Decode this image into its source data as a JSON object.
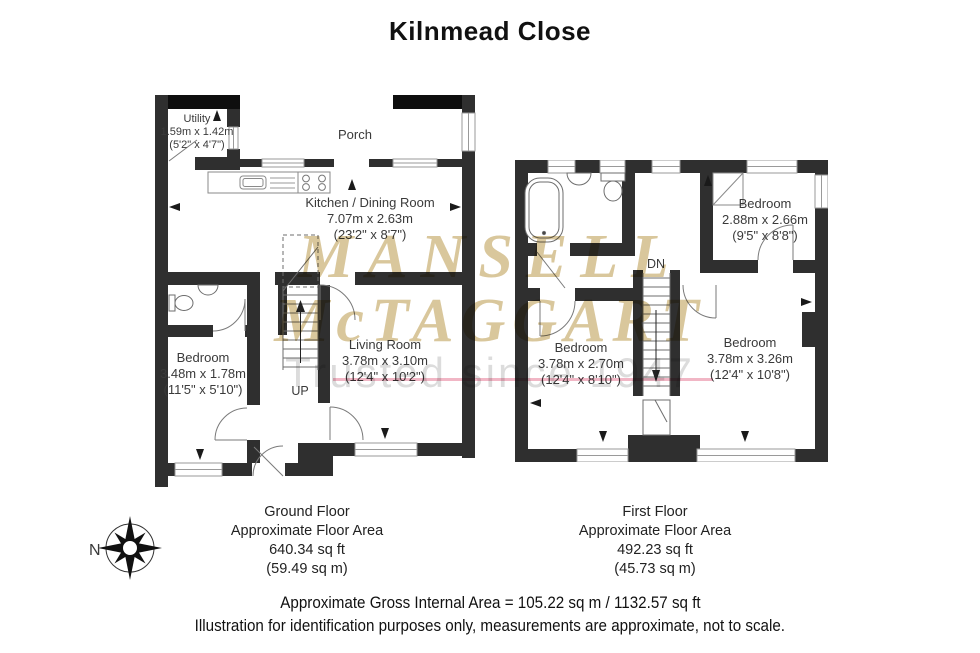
{
  "title": "Kilnmead Close",
  "watermark": {
    "line1": "MANSELL",
    "line2": "McTAGGART",
    "tagline": "Trusted since 1947"
  },
  "compass": {
    "north_label": "N"
  },
  "ground_floor": {
    "stairs_label": "UP",
    "rooms": {
      "utility": {
        "name": "Utility",
        "dim_m": "1.59m x 1.42m",
        "dim_ft": "(5'2\" x 4'7\")"
      },
      "porch": {
        "name": "Porch"
      },
      "kitchen": {
        "name": "Kitchen / Dining Room",
        "dim_m": "7.07m x 2.63m",
        "dim_ft": "(23'2\" x 8'7\")"
      },
      "bedroom": {
        "name": "Bedroom",
        "dim_m": "3.48m x 1.78m",
        "dim_ft": "(11'5\" x 5'10\")"
      },
      "living": {
        "name": "Living Room",
        "dim_m": "3.78m x 3.10m",
        "dim_ft": "(12'4\" x 10'2\")"
      }
    },
    "caption": {
      "line1": "Ground Floor",
      "line2": "Approximate Floor Area",
      "line3": "640.34 sq ft",
      "line4": "(59.49 sq m)"
    }
  },
  "first_floor": {
    "stairs_label": "DN",
    "rooms": {
      "bedroom_top": {
        "name": "Bedroom",
        "dim_m": "2.88m x 2.66m",
        "dim_ft": "(9'5\" x 8'8\")"
      },
      "bedroom_left": {
        "name": "Bedroom",
        "dim_m": "3.78m x 2.70m",
        "dim_ft": "(12'4\" x 8'10\")"
      },
      "bedroom_right": {
        "name": "Bedroom",
        "dim_m": "3.78m x 3.26m",
        "dim_ft": "(12'4\" x 10'8\")"
      }
    },
    "caption": {
      "line1": "First Floor",
      "line2": "Approximate Floor Area",
      "line3": "492.23 sq ft",
      "line4": "(45.73 sq m)"
    }
  },
  "footer": {
    "line1": "Approximate Gross Internal Area = 105.22 sq m / 1132.57 sq ft",
    "line2": "Illustration for identification purposes only, measurements are approximate, not to scale."
  },
  "colors": {
    "wall": "#2f2f2f",
    "wall_dark": "#0e0e0e",
    "watermark_tan": "#d9c79c",
    "watermark_gray": "#dcdcdc",
    "accent_pink": "#f1b6c5",
    "text": "#3c3c3c"
  }
}
